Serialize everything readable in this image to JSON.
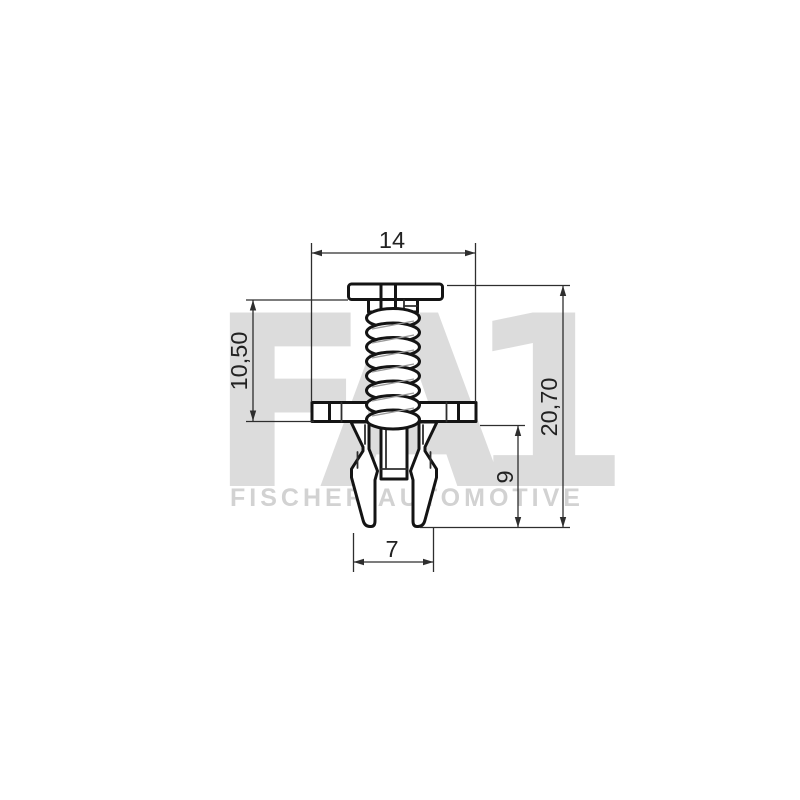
{
  "page": {
    "background_color": "#ffffff",
    "description": "Technical side-view drawing of an automotive expanding rivet clip with dimensions"
  },
  "watermark": {
    "logo_fa": "FA",
    "logo_one": "1",
    "wordmark": "FISCHER AUTOMOTIVE",
    "logo_color": "#dcdcdc",
    "wordmark_color": "#d2d2d2"
  },
  "drawing": {
    "line_color": "#141414",
    "dimension_color": "#2e2e2e",
    "dimensions": {
      "flange_width": {
        "label": "14",
        "orientation": "horizontal",
        "position": "top"
      },
      "grip_length": {
        "label": "10,50",
        "orientation": "vertical",
        "position": "left"
      },
      "overall_length": {
        "label": "20,70",
        "orientation": "vertical",
        "position": "right"
      },
      "leg_length": {
        "label": "9",
        "orientation": "vertical",
        "position": "right-inner"
      },
      "tip_span": {
        "label": "7",
        "orientation": "horizontal",
        "position": "bottom"
      }
    }
  }
}
